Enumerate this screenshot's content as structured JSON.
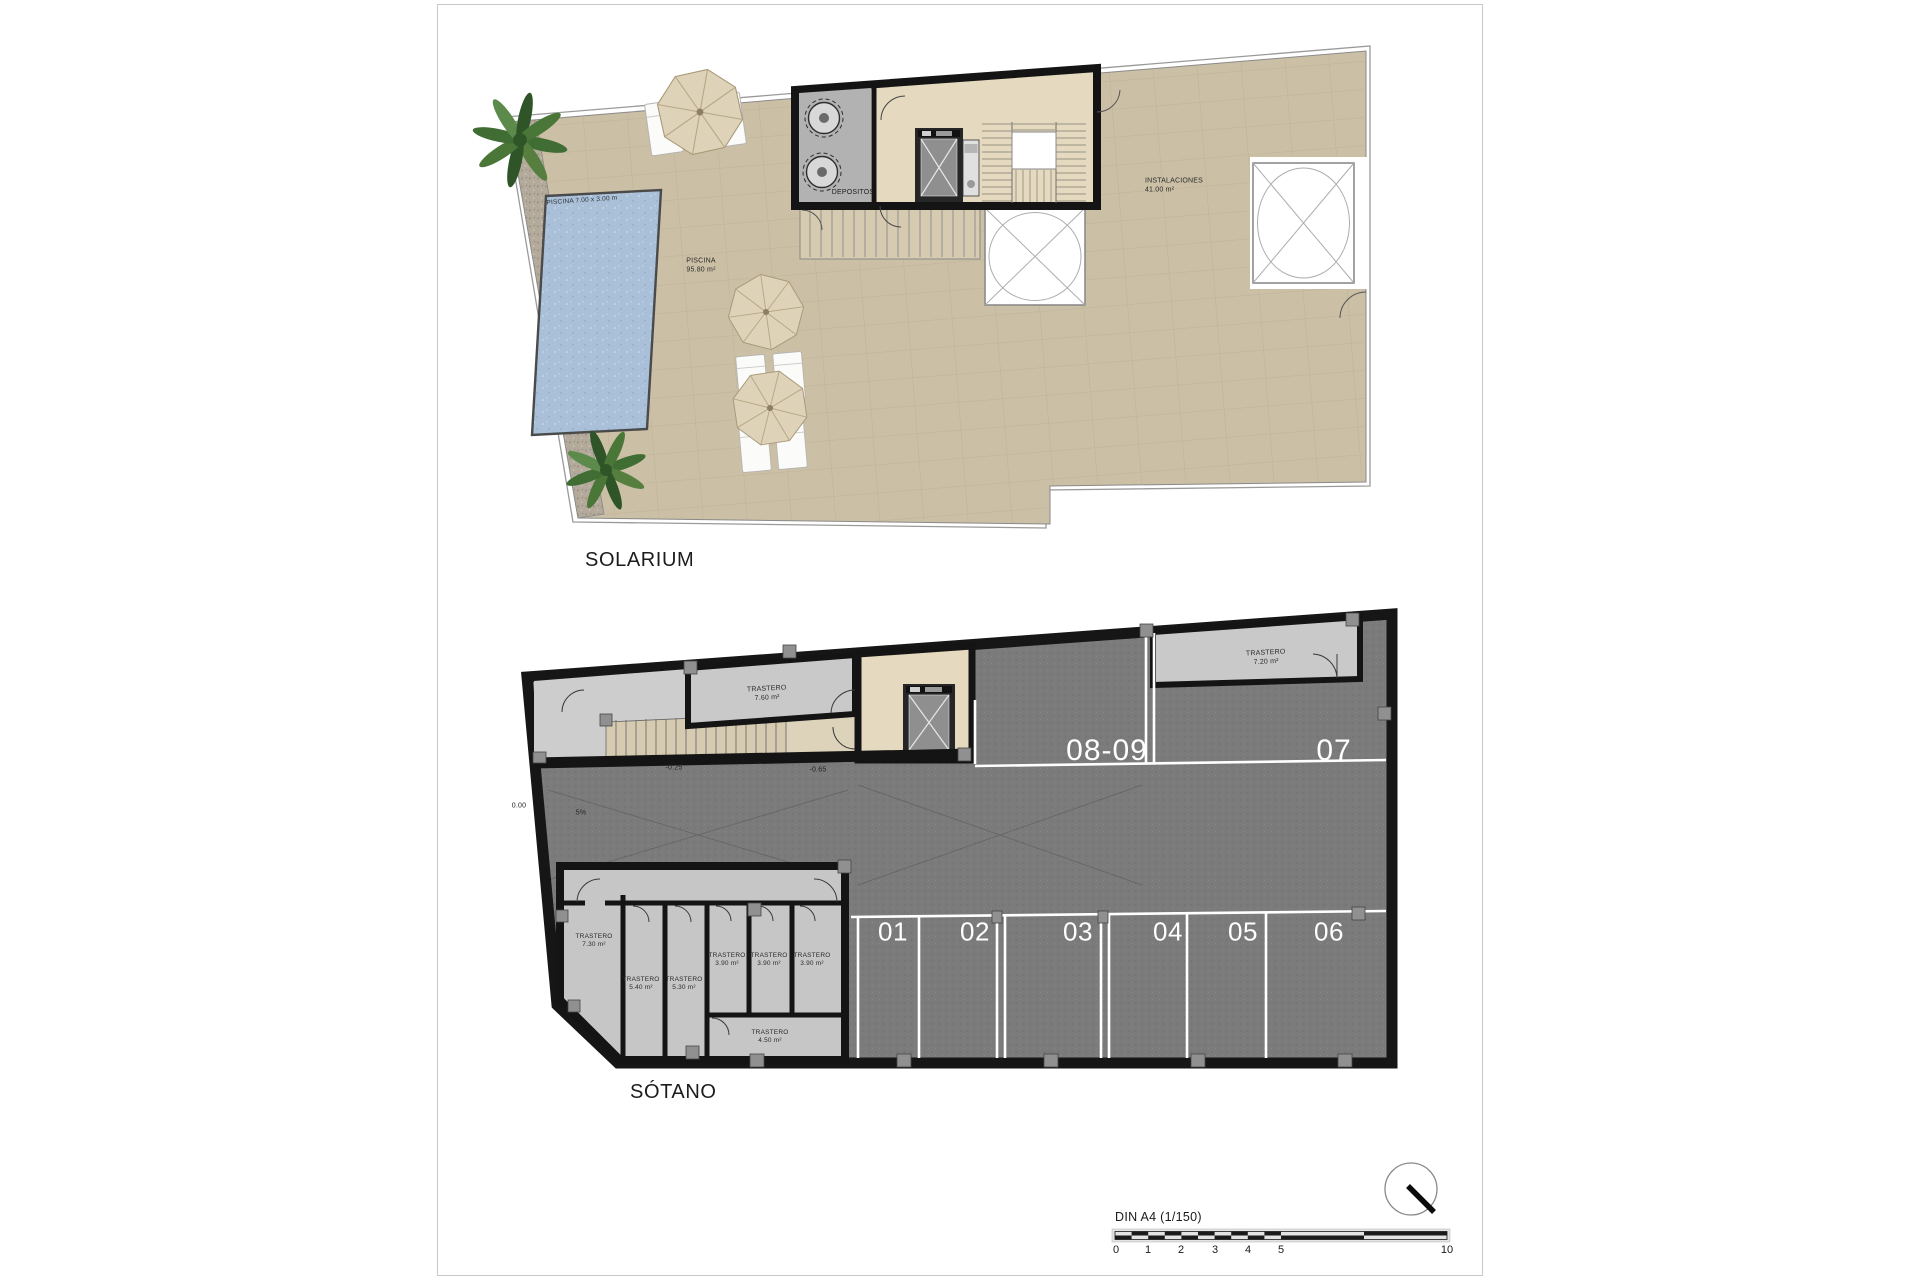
{
  "solarium": {
    "title": "SOLARIUM",
    "pool_dim_label": "PISCINA 7.00 x 3.00 m",
    "pool_room": {
      "name": "PISCINA",
      "area": "95.80 m²"
    },
    "depositos_label": "DEPOSITOS",
    "instalaciones": {
      "name": "INSTALACIONES",
      "area": "41.00 m²"
    }
  },
  "sotano": {
    "title": "SÓTANO",
    "upper_spots": [
      "08-09",
      "07"
    ],
    "lower_spots": [
      "01",
      "02",
      "03",
      "04",
      "05",
      "06"
    ],
    "trastero_top": {
      "name": "TRASTERO",
      "area": "7.60 m²"
    },
    "trastero_right": {
      "name": "TRASTERO",
      "area": "7.20 m²"
    },
    "storage_rooms": [
      {
        "name": "TRASTERO",
        "area": "7.30 m²"
      },
      {
        "name": "TRASTERO",
        "area": "5.40 m²"
      },
      {
        "name": "TRASTERO",
        "area": "5.30 m²"
      },
      {
        "name": "TRASTERO",
        "area": "3.90 m²"
      },
      {
        "name": "TRASTERO",
        "area": "3.90 m²"
      },
      {
        "name": "TRASTERO",
        "area": "3.90 m²"
      },
      {
        "name": "TRASTERO",
        "area": "4.50 m²"
      }
    ],
    "annotations": {
      "level_zero": "0.00",
      "slope": "5%",
      "level_mid": "-0.25",
      "level_right": "-0.65"
    }
  },
  "footer": {
    "scale_label": "DIN A4 (1/150)",
    "scale_ticks": [
      "0",
      "1",
      "2",
      "3",
      "4",
      "5",
      "10"
    ]
  },
  "colors": {
    "deck": "#cbbfa5",
    "pool": "#a9c0d8",
    "parking": "#7b7b7b",
    "storage": "#c6c6c6",
    "core_floor": "#e5dabf",
    "wall": "#161616",
    "gravel": "#b3aa9b",
    "palm": "#3f6d33",
    "parasol": "#ded3b8"
  }
}
